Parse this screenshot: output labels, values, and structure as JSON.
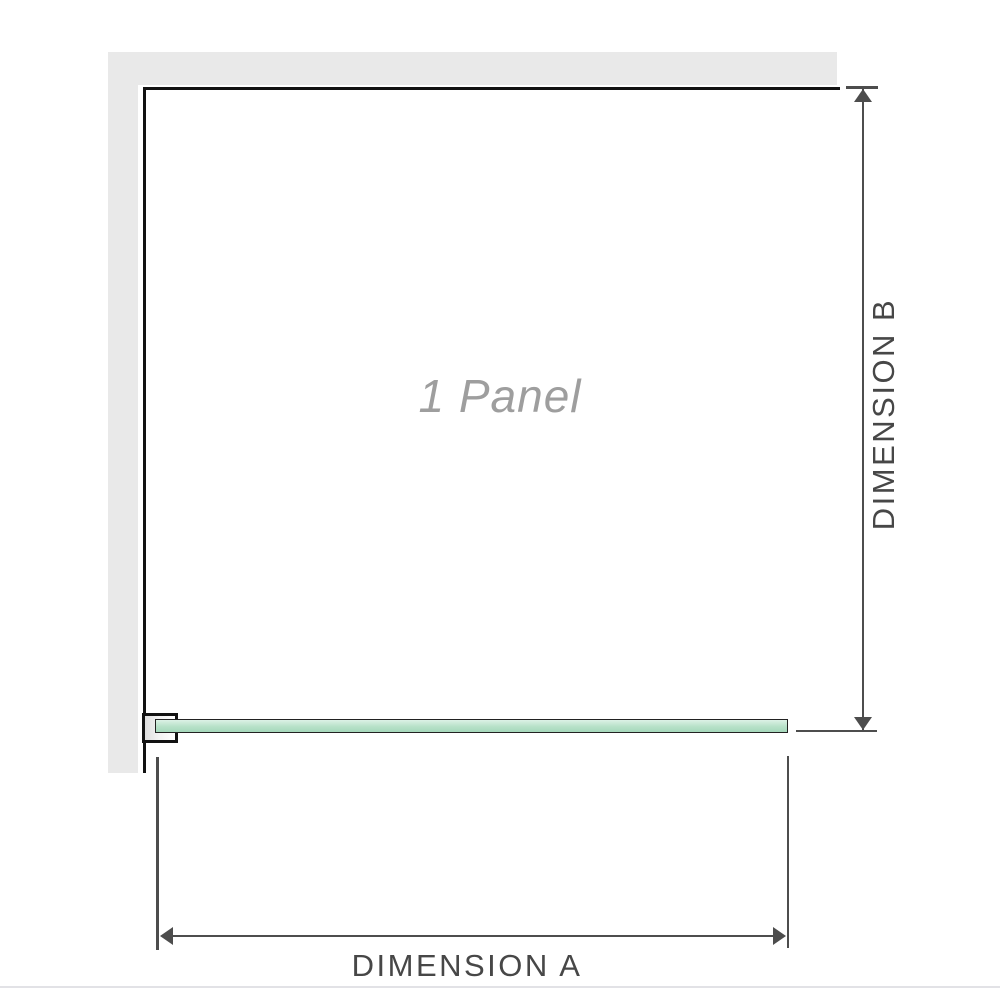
{
  "diagram": {
    "panel_label": "1 Panel",
    "dimension_a": {
      "label": "DIMENSION A"
    },
    "dimension_b": {
      "label": "DIMENSION B"
    }
  },
  "theme": {
    "wall": "#e9e9e9",
    "wall-edge": "#121212",
    "glass-border": "#222222",
    "glass-light": "#ddf1e6",
    "glass-mid": "#b7e1c8",
    "glass-dark": "#a5d8bb",
    "dim": "#4d4d4d",
    "label-text": "#474747",
    "panel-text": "#9e9e9e",
    "divider": "#e2e2e6"
  }
}
